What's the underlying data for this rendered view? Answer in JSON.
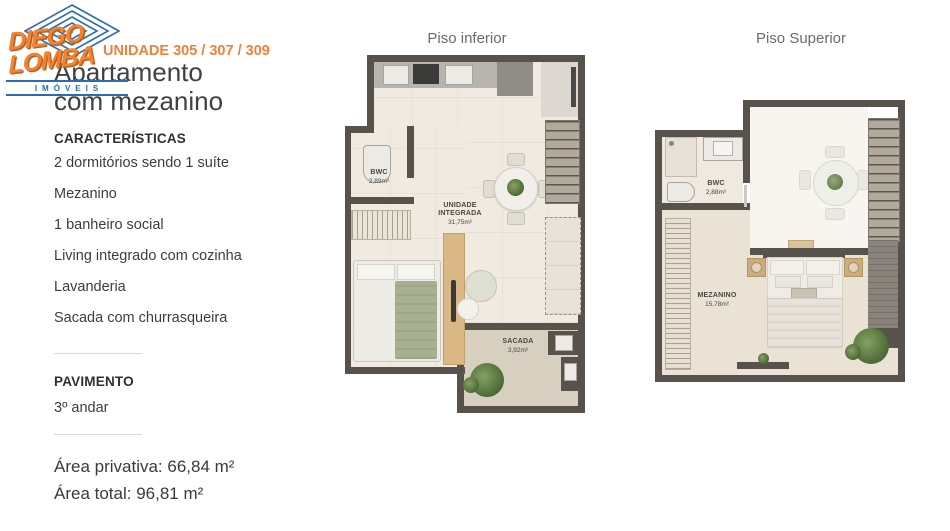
{
  "brand": {
    "line1": "DIEGO",
    "line2": "LOMBA",
    "sub": "IMÓVEIS",
    "accent_orange": "#ee8434",
    "accent_blue": "#2a6cb3"
  },
  "header": {
    "unit": "UNIDADE 305 / 307 / 309",
    "title": "Apartamento com mezanino"
  },
  "features": {
    "heading": "CARACTERÍSTICAS",
    "items": [
      "2 dormitórios sendo 1 suíte",
      "Mezanino",
      "1 banheiro social",
      "Living integrado com cozinha",
      "Lavanderia",
      "Sacada com churrasqueira"
    ]
  },
  "floor_info": {
    "heading": "PAVIMENTO",
    "value": "3º andar"
  },
  "areas": {
    "private": "Área privativa: 66,84 m²",
    "total": "Área total: 96,81 m²"
  },
  "plans": {
    "lower": {
      "title": "Piso inferior",
      "rooms": [
        {
          "name": "BWC",
          "area": "2,89m²"
        },
        {
          "name": "UNIDADE INTEGRADA",
          "area": "31,75m²"
        },
        {
          "name": "SACADA",
          "area": "3,92m²"
        }
      ]
    },
    "upper": {
      "title": "Piso Superior",
      "rooms": [
        {
          "name": "BWC",
          "area": "2,88m²"
        },
        {
          "name": "MEZANINO",
          "area": "15,78m²"
        }
      ]
    }
  },
  "colors": {
    "wall": "#57534c",
    "floor": "#f0eae1",
    "balcony_floor": "#d7cfc0"
  }
}
